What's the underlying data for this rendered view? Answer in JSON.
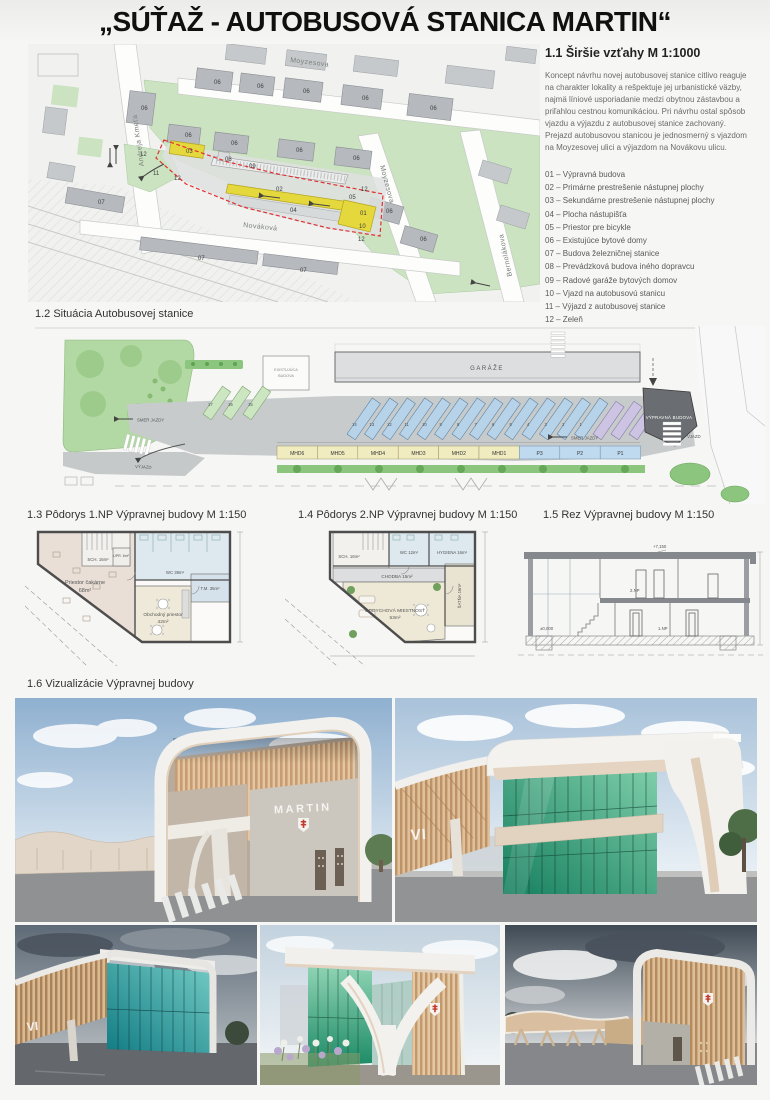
{
  "title": "„SÚŤAŽ - AUTOBUSOVÁ STANICA MARTIN“",
  "s11": {
    "heading": "1.1 Širšie vzťahy M 1:1000",
    "paragraph": "Koncept návrhu novej autobusovej stanice citlivo reaguje na charakter lokality a rešpektuje jej urbanistické väzby, najmä líniové usporiadanie medzi obytnou zástavbou a priľahlou cestnou komunikáciou.  Pri návrhu ostal spôsob vjazdu a výjazdu z autobusovej stanice zachovaný. Prejazd autobusovou stanicou je jednosmerný s vjazdom na Moyzesovej ulici a výjazdom na Novákovu ulicu.",
    "legend": [
      "01 – Výpravná budova",
      "02 – Primárne prestrešenie nástupnej plochy",
      "03 – Sekundárne prestrešenie nástupnej plochy",
      "04 – Plocha nástupišťa",
      "05 – Priestor pre bicykle",
      "06 – Existujúce bytové domy",
      "07 – Budova železničnej stanice",
      "08 – Prevádzková budova iného dopravcu",
      "09 – Radové garáže bytových domov",
      "10 – Vjazd na autobusovú stanicu",
      "11 – Výjazd z autobusovej stanice",
      "12 – Zeleň"
    ],
    "map": {
      "labels": [
        {
          "t": "Moyzesova",
          "x": 262,
          "y": 18,
          "r": 7,
          "cls": "street"
        },
        {
          "t": "Moyzesova",
          "x": 352,
          "y": 122,
          "r": 75,
          "cls": "street"
        },
        {
          "t": "Andreja Kmeťa",
          "x": 116,
          "y": 122,
          "r": -98,
          "cls": "street"
        },
        {
          "t": "Bernolákova",
          "x": 484,
          "y": 232,
          "r": -102,
          "cls": "street"
        },
        {
          "t": "Nováková",
          "x": 215,
          "y": 183,
          "r": 6,
          "cls": "street"
        },
        {
          "t": "06",
          "x": 113,
          "y": 66
        },
        {
          "t": "06",
          "x": 186,
          "y": 40
        },
        {
          "t": "06",
          "x": 229,
          "y": 44
        },
        {
          "t": "06",
          "x": 275,
          "y": 49
        },
        {
          "t": "06",
          "x": 334,
          "y": 56
        },
        {
          "t": "06",
          "x": 402,
          "y": 66
        },
        {
          "t": "06",
          "x": 157,
          "y": 93
        },
        {
          "t": "06",
          "x": 203,
          "y": 101
        },
        {
          "t": "06",
          "x": 268,
          "y": 108
        },
        {
          "t": "06",
          "x": 325,
          "y": 116
        },
        {
          "t": "06",
          "x": 358,
          "y": 169
        },
        {
          "t": "06",
          "x": 392,
          "y": 197
        },
        {
          "t": "12",
          "x": 112,
          "y": 112
        },
        {
          "t": "12",
          "x": 146,
          "y": 136
        },
        {
          "t": "12",
          "x": 333,
          "y": 147
        },
        {
          "t": "12",
          "x": 330,
          "y": 197
        },
        {
          "t": "11",
          "x": 125,
          "y": 131
        },
        {
          "t": "10",
          "x": 331,
          "y": 184
        },
        {
          "t": "01",
          "x": 332,
          "y": 171
        },
        {
          "t": "05",
          "x": 321,
          "y": 155
        },
        {
          "t": "02",
          "x": 248,
          "y": 147
        },
        {
          "t": "04",
          "x": 262,
          "y": 168
        },
        {
          "t": "03",
          "x": 158,
          "y": 109
        },
        {
          "t": "08",
          "x": 197,
          "y": 117
        },
        {
          "t": "09",
          "x": 221,
          "y": 124
        },
        {
          "t": "07",
          "x": 70,
          "y": 160
        },
        {
          "t": "07",
          "x": 170,
          "y": 216
        },
        {
          "t": "07",
          "x": 272,
          "y": 228
        }
      ]
    }
  },
  "s12": {
    "heading": "1.2 Situácia Autobusovej stanice",
    "labels": {
      "garaze": "GARÁŽE",
      "exist1": "EXISTUJÚCA",
      "exist2": "BUDOVA",
      "vypravna": "VÝPRAVNÁ BUDOVA",
      "smer": "SMER JAZDY",
      "vjazd": "VJAZD",
      "vyjazd": "VÝJAZD"
    },
    "stands": [
      {
        "l": "MHD6",
        "t": "mhd"
      },
      {
        "l": "MHD5",
        "t": "mhd"
      },
      {
        "l": "MHD4",
        "t": "mhd"
      },
      {
        "l": "MHD3",
        "t": "mhd"
      },
      {
        "l": "MHD2",
        "t": "mhd"
      },
      {
        "l": "MHD1",
        "t": "mhd"
      },
      {
        "l": "P3",
        "t": "p"
      },
      {
        "l": "P2",
        "t": "p"
      },
      {
        "l": "P1",
        "t": "p"
      }
    ],
    "bays": [
      {
        "n": "17",
        "x": 168,
        "y": 88,
        "len": 34,
        "c": "g"
      },
      {
        "n": "16",
        "x": 188,
        "y": 88,
        "len": 34,
        "c": "g"
      },
      {
        "n": "15",
        "x": 208,
        "y": 88,
        "len": 34,
        "c": "g"
      },
      {
        "n": "14",
        "x": 312,
        "y": 108,
        "len": 44,
        "c": "b"
      },
      {
        "n": "13",
        "x": 329.5,
        "y": 108,
        "len": 44,
        "c": "b"
      },
      {
        "n": "12",
        "x": 347,
        "y": 108,
        "len": 44,
        "c": "b"
      },
      {
        "n": "11",
        "x": 364.5,
        "y": 108,
        "len": 44,
        "c": "b"
      },
      {
        "n": "10",
        "x": 382,
        "y": 108,
        "len": 44,
        "c": "b"
      },
      {
        "n": "9",
        "x": 399.5,
        "y": 108,
        "len": 44,
        "c": "b"
      },
      {
        "n": "8",
        "x": 417,
        "y": 108,
        "len": 44,
        "c": "b"
      },
      {
        "n": "7",
        "x": 434.5,
        "y": 108,
        "len": 44,
        "c": "b"
      },
      {
        "n": "6",
        "x": 452,
        "y": 108,
        "len": 44,
        "c": "b"
      },
      {
        "n": "5",
        "x": 469.5,
        "y": 108,
        "len": 44,
        "c": "b"
      },
      {
        "n": "4",
        "x": 487,
        "y": 108,
        "len": 44,
        "c": "b"
      },
      {
        "n": "3",
        "x": 504.5,
        "y": 108,
        "len": 44,
        "c": "b"
      },
      {
        "n": "2",
        "x": 522,
        "y": 108,
        "len": 44,
        "c": "b"
      },
      {
        "n": "1",
        "x": 539.5,
        "y": 108,
        "len": 44,
        "c": "b"
      },
      {
        "n": "",
        "x": 558,
        "y": 108,
        "len": 40,
        "c": "v"
      },
      {
        "n": "",
        "x": 576,
        "y": 108,
        "len": 40,
        "c": "v"
      },
      {
        "n": "",
        "x": 594,
        "y": 108,
        "len": 40,
        "c": "v"
      }
    ]
  },
  "s13": {
    "heading": "1.3 Pôdorys  1.NP Výpravnej budovy  M 1:150",
    "rooms": {
      "cakaren": [
        "Priestor čakárne",
        "68m²"
      ],
      "obchod": [
        "Obchodný priestor",
        "42m²"
      ],
      "wc": "WC  39m²",
      "tm": "T.M. 35m²",
      "sch": "SCH. 16m²",
      "upr": "UPR. 6m²"
    }
  },
  "s14": {
    "heading": "1.4 Pôdorys  2.NP Výpravnej budovy  M 1:150",
    "rooms": {
      "chodba": "CHODBA  15m²",
      "oddych": [
        "ODDYCHOVÁ MIESTNOSŤ",
        "53m²"
      ],
      "wc": "WC  12m²",
      "hygiena": "HYGIENA  16m²",
      "satna": "ŠATŇA  16m²",
      "sch": "SCH. 16m²"
    }
  },
  "s15": {
    "heading": "1.5 Rez  Výpravnej budovy  M 1:150",
    "marks": {
      "top": "+7,150",
      "np2": "2.NP",
      "np1": "1.NP",
      "zero": "±0,000"
    }
  },
  "s16": {
    "heading": "1.6 Vizualizácie Výpravnej budovy",
    "signs": {
      "martin": "MARTIN",
      "vi": "VI"
    }
  }
}
